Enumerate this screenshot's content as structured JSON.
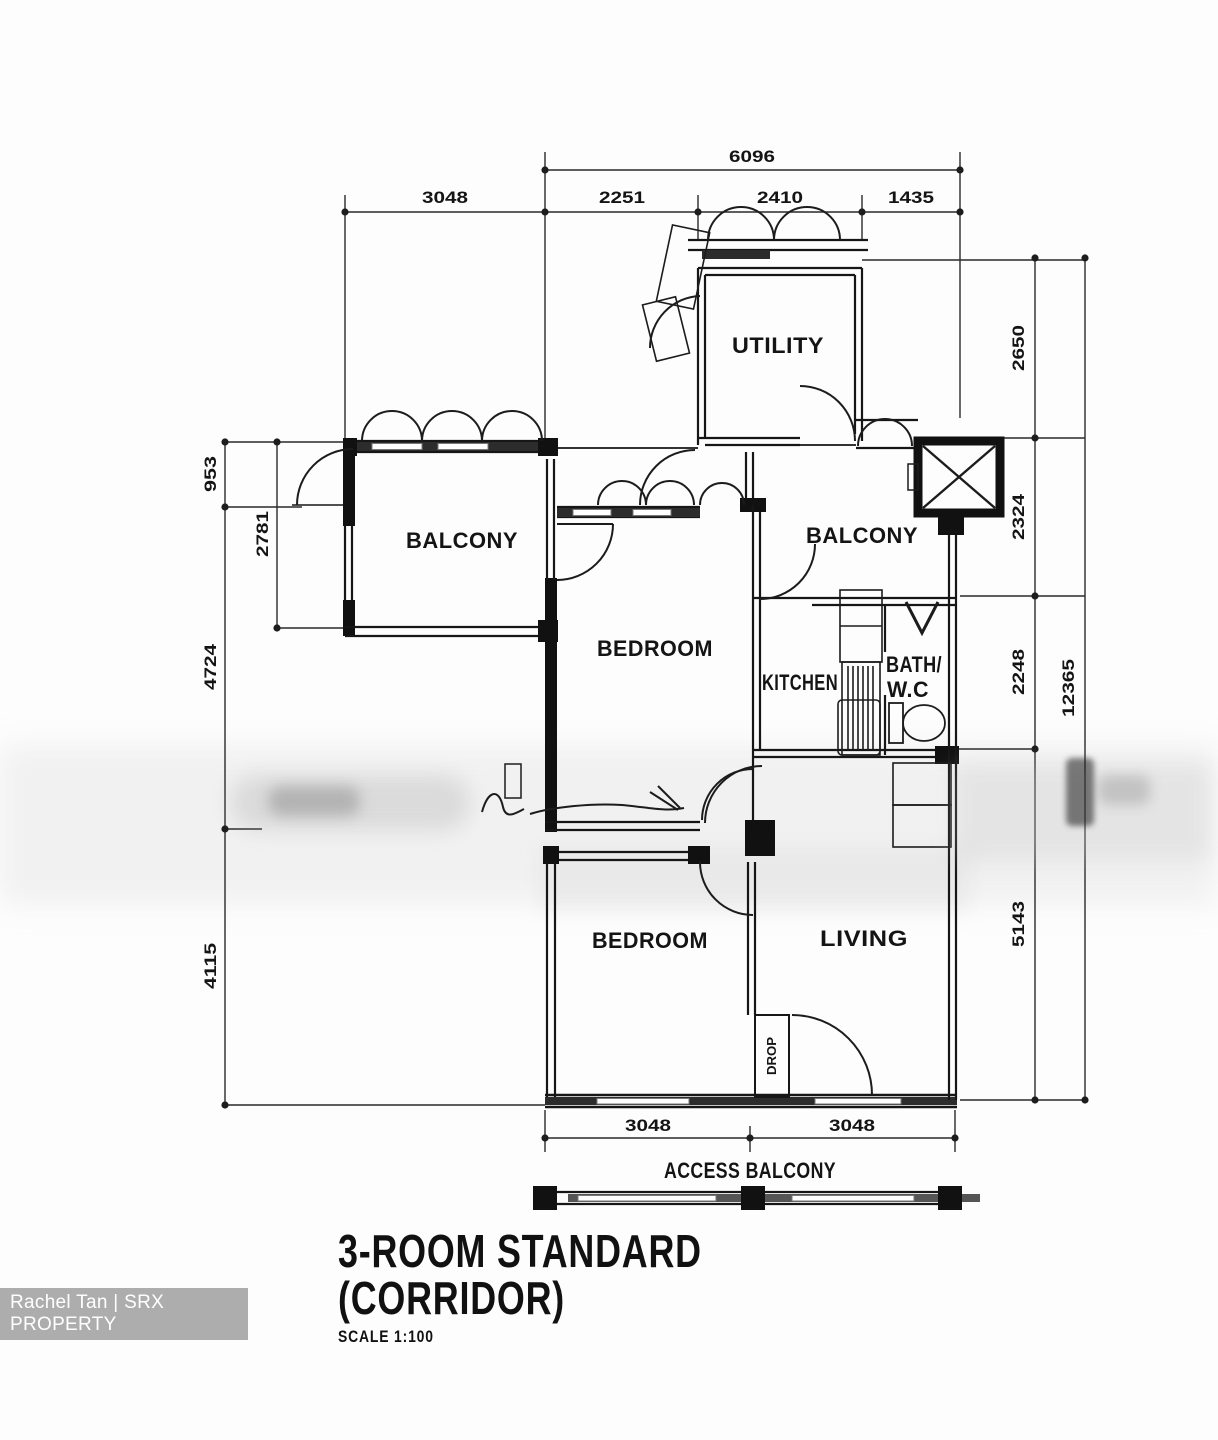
{
  "title": {
    "line1": "3-ROOM STANDARD",
    "line2": "(CORRIDOR)",
    "scale_label": "SCALE 1:100"
  },
  "watermark": {
    "text": "Rachel Tan | SRX PROPERTY"
  },
  "rooms": {
    "utility": "UTILITY",
    "balcony_left": "BALCONY",
    "balcony_right": "BALCONY",
    "bedroom_mid": "BEDROOM",
    "kitchen": "KITCHEN",
    "bath_line1": "BATH/",
    "bath_line2": "W.C",
    "bedroom_lower": "BEDROOM",
    "living": "LIVING",
    "drop": "DROP",
    "access_balcony": "ACCESS BALCONY"
  },
  "dims": {
    "top": {
      "overall": "6096",
      "segments": [
        "3048",
        "2251",
        "2410",
        "1435"
      ]
    },
    "left": {
      "outer": [
        "953",
        "4724",
        "4115"
      ],
      "inner": "2781"
    },
    "right": {
      "inner": [
        "2650",
        "2324",
        "2248",
        "5143"
      ],
      "outer": "12365"
    },
    "bottom": [
      "3048",
      "3048"
    ]
  },
  "colors": {
    "line": "#161616",
    "wall_fill": "#111111",
    "band_fill": "#2c2c2c"
  }
}
